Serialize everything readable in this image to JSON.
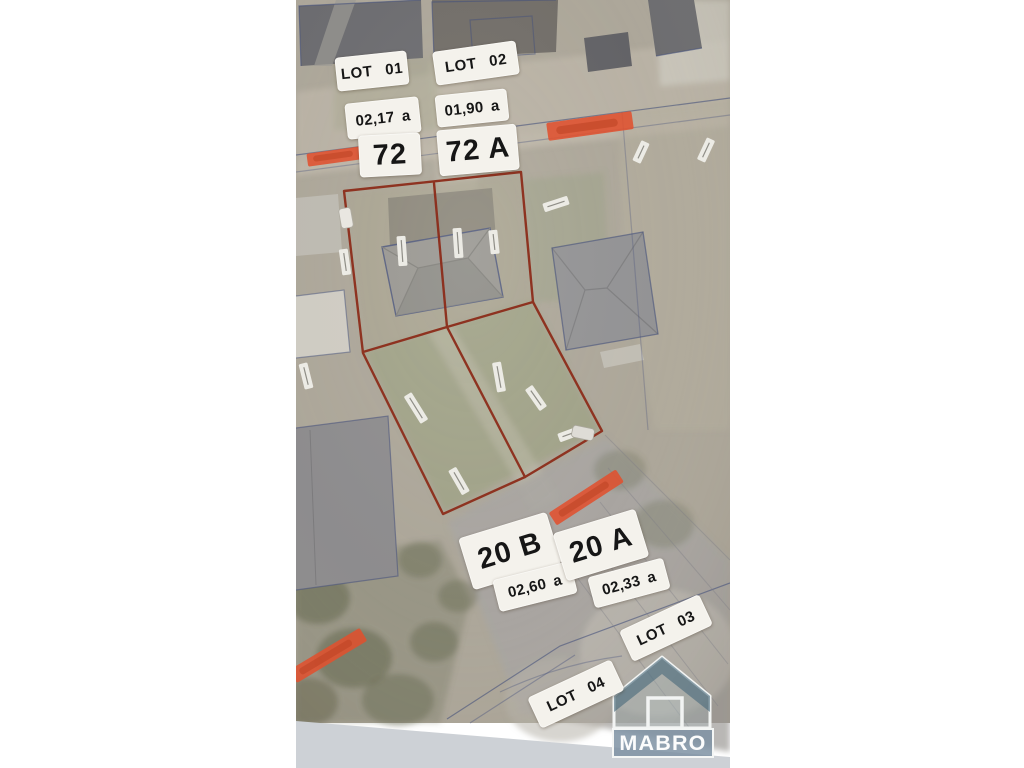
{
  "photo": {
    "description": "aerial cadastral site plan photo with plot markings",
    "plot_labels": [
      {
        "name": "lot-01",
        "text": "LOT 01"
      },
      {
        "name": "lot-02",
        "text": "LOT 02"
      },
      {
        "name": "area-lot-01",
        "text": "02,17 a"
      },
      {
        "name": "area-lot-02",
        "text": "01,90 a"
      },
      {
        "name": "house-number-72",
        "text": "72"
      },
      {
        "name": "house-number-72a",
        "text": "72 A"
      },
      {
        "name": "house-number-20b",
        "text": "20 B"
      },
      {
        "name": "area-20b",
        "text": "02,60 a"
      },
      {
        "name": "house-number-20a",
        "text": "20 A"
      },
      {
        "name": "area-20a",
        "text": "02,33 a"
      },
      {
        "name": "lot-03",
        "text": "LOT 03"
      },
      {
        "name": "lot-04",
        "text": "LOT 04"
      }
    ],
    "logo": {
      "text": "MABRO"
    },
    "colors": {
      "plot_outline": "#8c2c1a",
      "street_highlight": "#e0512f",
      "street_highlight_text": "#bb4122",
      "cadastral_line": "#46517c",
      "logo_roof": "#46677a",
      "logo_band": "#7e92a3",
      "label_background": "#f4f2ec"
    }
  }
}
